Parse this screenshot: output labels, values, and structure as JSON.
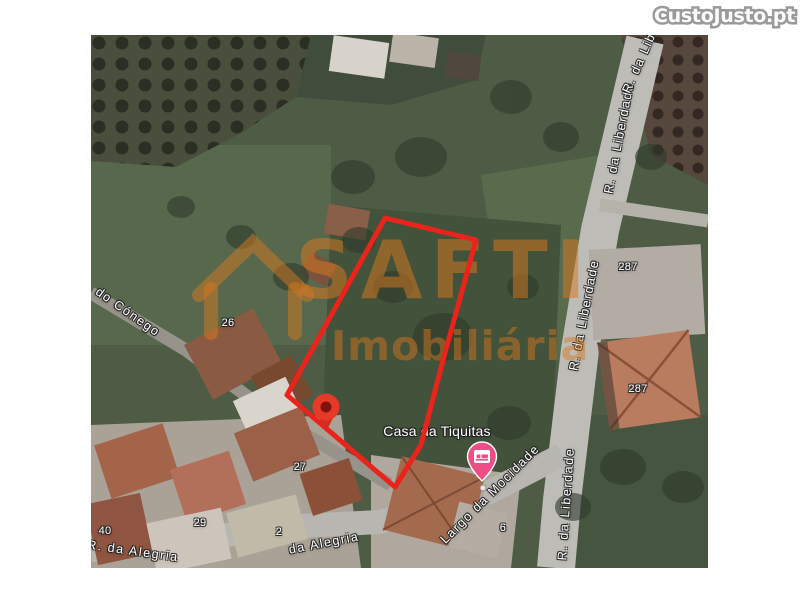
{
  "header": {
    "logo_text": "CustoJusto.pt"
  },
  "map": {
    "watermark": {
      "brand": "SAFTI",
      "tagline": "Imobiliária"
    },
    "place_label": "Casa da Tiquitas",
    "street_labels": [
      {
        "id": "do-conego",
        "text": "do Cónego"
      },
      {
        "id": "liberdade-top",
        "text": "R. da Liberdade"
      },
      {
        "id": "liberdade-top-partial",
        "text": "R. da Lib"
      },
      {
        "id": "liberdade-mid",
        "text": "R. da Liberdade"
      },
      {
        "id": "liberdade-bottom",
        "text": "R. da Liberdade"
      },
      {
        "id": "largo-mocidade",
        "text": "Largo da Mocidade"
      },
      {
        "id": "alegria-left",
        "text": "R. da Alegria"
      },
      {
        "id": "alegria-mid",
        "text": "da Alegria"
      }
    ],
    "number_labels": [
      "26",
      "27",
      "287",
      "287",
      "40",
      "29",
      "2",
      "6"
    ],
    "colors": {
      "plot_outline": "#ea231b",
      "watermark_orange": "#d8781e",
      "pin_red": "#e63928",
      "pin_red_center": "#7e120e",
      "lodging_pin_pink": "#ee4d85",
      "road_gray": "#bdbcb6",
      "field_green": "#4e5c46"
    }
  }
}
